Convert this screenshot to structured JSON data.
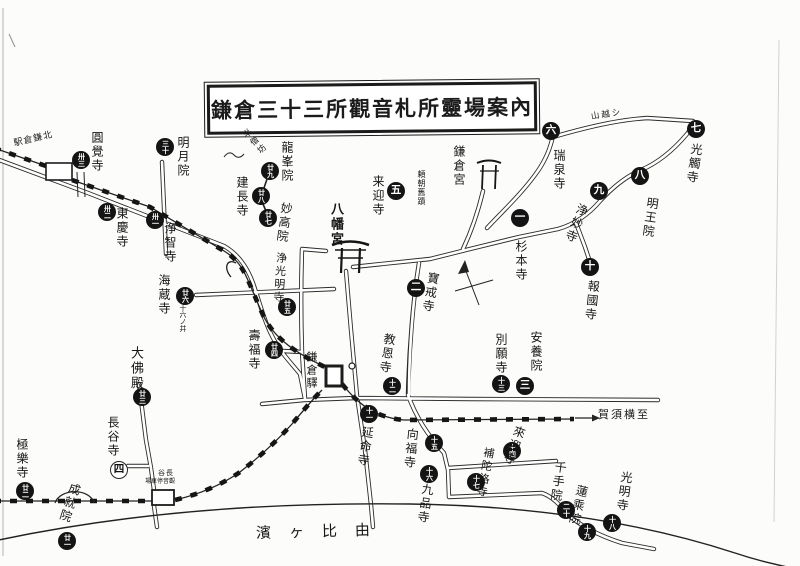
{
  "title": "鎌倉三十三所觀音札所靈場案內",
  "colors": {
    "ink": "#1b1b1b",
    "paper": "#fcfcfa"
  },
  "labels": {
    "beach": "濱ヶ比由",
    "to_yokosuka": "賀須横至",
    "kitakamakura_station": "駅倉鎌北",
    "kamakura_station": "鎌倉驛",
    "hase_station_line1": "谷長",
    "hase_station_line2": "場車停音觀",
    "yoritomo_site": "頼朝舊蹟",
    "sixteen_wells": "十六ノ井",
    "hansobo": "半僧坊",
    "yamagoe_path": "山越シ",
    "hachimangu": "八幡宮",
    "kamakuragu": "鎌倉宮"
  },
  "map": {
    "sites": [
      {
        "no": 1,
        "num": "一",
        "name": "杉本寺",
        "bx": 520,
        "by": 218,
        "lx": 515,
        "ly": 240,
        "fs": 12,
        "rot": 0,
        "open": false
      },
      {
        "no": 2,
        "num": "二",
        "name": "寶戒寺",
        "bx": 416,
        "by": 288,
        "lx": 428,
        "ly": 272,
        "fs": 12,
        "rot": 10,
        "open": false
      },
      {
        "no": 3,
        "num": "三",
        "name": "安養院",
        "bx": 525,
        "by": 386,
        "lx": 530,
        "ly": 331,
        "fs": 12,
        "rot": 0,
        "open": false
      },
      {
        "no": 4,
        "num": "四",
        "name": "長谷寺",
        "bx": 119,
        "by": 470,
        "lx": 107,
        "ly": 416,
        "fs": 12,
        "rot": 0,
        "open": true
      },
      {
        "no": 5,
        "num": "五",
        "name": "来迎寺",
        "bx": 396,
        "by": 191,
        "lx": 372,
        "ly": 175,
        "fs": 12,
        "rot": 0,
        "open": false
      },
      {
        "no": 6,
        "num": "六",
        "name": "瑞泉寺",
        "bx": 551,
        "by": 131,
        "lx": 553,
        "ly": 149,
        "fs": 12,
        "rot": 0,
        "open": false
      },
      {
        "no": 7,
        "num": "七",
        "name": "光觸寺",
        "bx": 696,
        "by": 129,
        "lx": 691,
        "ly": 143,
        "fs": 12,
        "rot": 8,
        "open": false
      },
      {
        "no": 8,
        "num": "八",
        "name": "明王院",
        "bx": 640,
        "by": 176,
        "lx": 647,
        "ly": 197,
        "fs": 12,
        "rot": 8,
        "open": false
      },
      {
        "no": 9,
        "num": "九",
        "name": "浄妙寺",
        "bx": 599,
        "by": 191,
        "lx": 578,
        "ly": 204,
        "fs": 12,
        "rot": 22,
        "open": false
      },
      {
        "no": 10,
        "num": "十",
        "name": "報國寺",
        "bx": 590,
        "by": 267,
        "lx": 588,
        "ly": 280,
        "fs": 12,
        "rot": 6,
        "open": false
      },
      {
        "no": 11,
        "num": "十一",
        "name": "延命寺",
        "bx": 369,
        "by": 414,
        "lx": 362,
        "ly": 426,
        "fs": 12,
        "rot": 8,
        "open": false
      },
      {
        "no": 12,
        "num": "十二",
        "name": "教恩寺",
        "bx": 392,
        "by": 386,
        "lx": 384,
        "ly": 333,
        "fs": 12,
        "rot": 8,
        "open": false
      },
      {
        "no": 13,
        "num": "十三",
        "name": "別願寺",
        "bx": 501,
        "by": 384,
        "lx": 495,
        "ly": 333,
        "fs": 12,
        "rot": 0,
        "open": false
      },
      {
        "no": 14,
        "num": "十四",
        "name": "來迎寺",
        "bx": 512,
        "by": 451,
        "lx": 515,
        "ly": 426,
        "fs": 12,
        "rot": 20,
        "open": false
      },
      {
        "no": 15,
        "num": "十五",
        "name": "向福寺",
        "bx": 434,
        "by": 443,
        "lx": 407,
        "ly": 428,
        "fs": 12,
        "rot": 6,
        "open": false
      },
      {
        "no": 16,
        "num": "十六",
        "name": "九品寺",
        "bx": 429,
        "by": 474,
        "lx": 422,
        "ly": 483,
        "fs": 12,
        "rot": 8,
        "open": false
      },
      {
        "no": 17,
        "num": "十七",
        "name": "補陀洛寺",
        "bx": 476,
        "by": 482,
        "lx": 483,
        "ly": 447,
        "fs": 11,
        "rot": 10,
        "open": false
      },
      {
        "no": 18,
        "num": "十八",
        "name": "光明寺",
        "bx": 612,
        "by": 523,
        "lx": 621,
        "ly": 471,
        "fs": 12,
        "rot": 8,
        "open": false
      },
      {
        "no": 19,
        "num": "十九",
        "name": "蓮乘院",
        "bx": 587,
        "by": 532,
        "lx": 577,
        "ly": 485,
        "fs": 12,
        "rot": 14,
        "open": false
      },
      {
        "no": 20,
        "num": "二十",
        "name": "千手院",
        "bx": 566,
        "by": 510,
        "lx": 555,
        "ly": 461,
        "fs": 12,
        "rot": 8,
        "open": false
      },
      {
        "no": 21,
        "num": "廿一",
        "name": "成就院",
        "bx": 67,
        "by": 541,
        "lx": 70,
        "ly": 483,
        "fs": 12,
        "rot": 18,
        "open": false
      },
      {
        "no": 22,
        "num": "廿二",
        "name": "極樂寺",
        "bx": 25,
        "by": 491,
        "lx": 16,
        "ly": 438,
        "fs": 12,
        "rot": 0,
        "open": false
      },
      {
        "no": 23,
        "num": "廿三",
        "name": "大佛殿",
        "bx": 142,
        "by": 397,
        "lx": 130,
        "ly": 346,
        "fs": 13,
        "rot": 0,
        "open": false
      },
      {
        "no": 24,
        "num": "廿四",
        "name": "壽福寺",
        "bx": 274,
        "by": 350,
        "lx": 248,
        "ly": 329,
        "fs": 12,
        "rot": 0,
        "open": false
      },
      {
        "no": 25,
        "num": "廿五",
        "name": "浄光明寺",
        "bx": 287,
        "by": 307,
        "lx": 275,
        "ly": 252,
        "fs": 11,
        "rot": 4,
        "open": false
      },
      {
        "no": 26,
        "num": "廿六",
        "name": "海蔵寺",
        "bx": 185,
        "by": 296,
        "lx": 158,
        "ly": 274,
        "fs": 12,
        "rot": 0,
        "open": false
      },
      {
        "no": 27,
        "num": "廿七",
        "name": "妙高院",
        "bx": 268,
        "by": 218,
        "lx": 281,
        "ly": 202,
        "fs": 12,
        "rot": 8,
        "open": false
      },
      {
        "no": 28,
        "num": "廿八",
        "name": "建長寺",
        "bx": 261,
        "by": 196,
        "lx": 236,
        "ly": 176,
        "fs": 12,
        "rot": 0,
        "open": false
      },
      {
        "no": 29,
        "num": "廿九",
        "name": "龍峯院",
        "bx": 270,
        "by": 171,
        "lx": 281,
        "ly": 141,
        "fs": 12,
        "rot": 0,
        "open": false
      },
      {
        "no": 30,
        "num": "三十",
        "name": "明月院",
        "bx": 165,
        "by": 147,
        "lx": 177,
        "ly": 136,
        "fs": 12,
        "rot": 0,
        "open": false
      },
      {
        "no": 31,
        "num": "卅一",
        "name": "浄智寺",
        "bx": 155,
        "by": 220,
        "lx": 164,
        "ly": 222,
        "fs": 12,
        "rot": 0,
        "open": false
      },
      {
        "no": 32,
        "num": "卅二",
        "name": "東慶寺",
        "bx": 107,
        "by": 212,
        "lx": 116,
        "ly": 207,
        "fs": 12,
        "rot": 0,
        "open": false
      },
      {
        "no": 33,
        "num": "卅三",
        "name": "圓覺寺",
        "bx": 81,
        "by": 160,
        "lx": 91,
        "ly": 131,
        "fs": 12,
        "rot": 0,
        "open": false
      }
    ]
  }
}
